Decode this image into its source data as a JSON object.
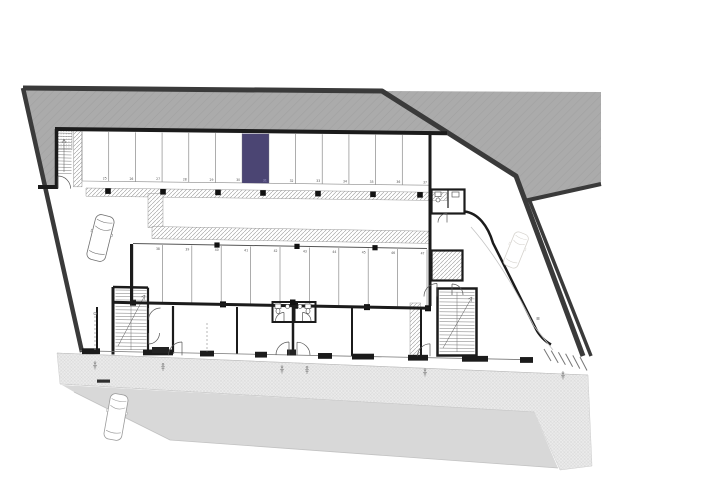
{
  "plan": {
    "type": "underground-parking-floor-plan",
    "top_row": {
      "stalls": [
        "25",
        "26",
        "27",
        "28",
        "29",
        "30",
        "31",
        "32",
        "33",
        "34",
        "35",
        "36",
        "37"
      ],
      "highlighted_stall": "31"
    },
    "middle_row": {
      "stalls": [
        "38",
        "39",
        "40",
        "41",
        "42",
        "43",
        "44",
        "45",
        "46",
        "47"
      ]
    },
    "colors": {
      "highlight": "#4b4573",
      "highlight_number": "#a39ed0",
      "site_gray": "#ababab",
      "boundary": "#3a3a3a",
      "wall": "#1b1b1b",
      "stall_line": "#8a8a8a",
      "number_color": "#555555",
      "road": "#d8d8d8",
      "sidewalk": "#ebebeb"
    }
  }
}
